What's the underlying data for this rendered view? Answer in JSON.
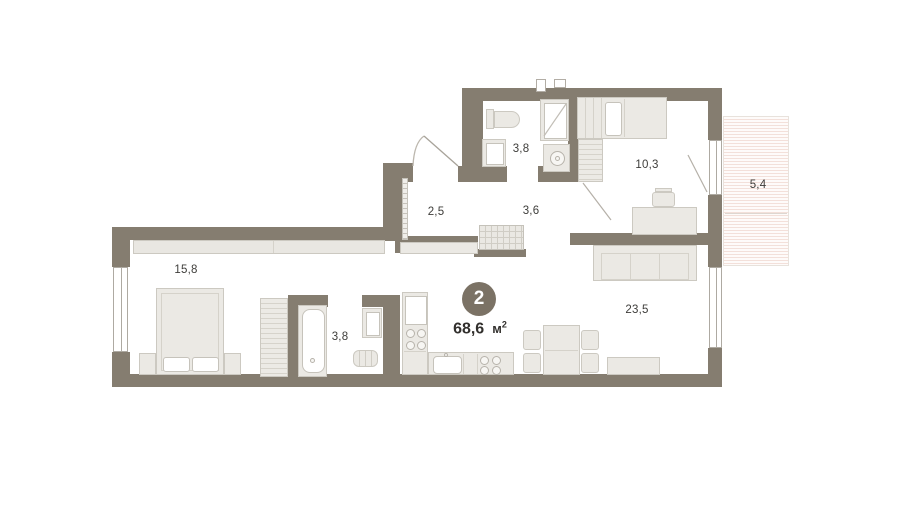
{
  "plan": {
    "type": "apartment-floor-plan",
    "badge_number": "2",
    "total_area": {
      "value": "68,6",
      "unit": "м",
      "sup": "2"
    },
    "rooms": {
      "bedroom": "15,8",
      "hallway": "2,5",
      "corridor": "3,6",
      "bathroom_top": "3,8",
      "bedroom_small": "10,3",
      "balcony": "5,4",
      "bathroom_bottom": "3,8",
      "living_kitchen": "23,5"
    },
    "colors": {
      "wall": "#857d70",
      "badge": "#7b7265",
      "furniture": "#ebe9e4",
      "balcony_hatch": "#f3e0da",
      "background": "#ffffff"
    }
  }
}
